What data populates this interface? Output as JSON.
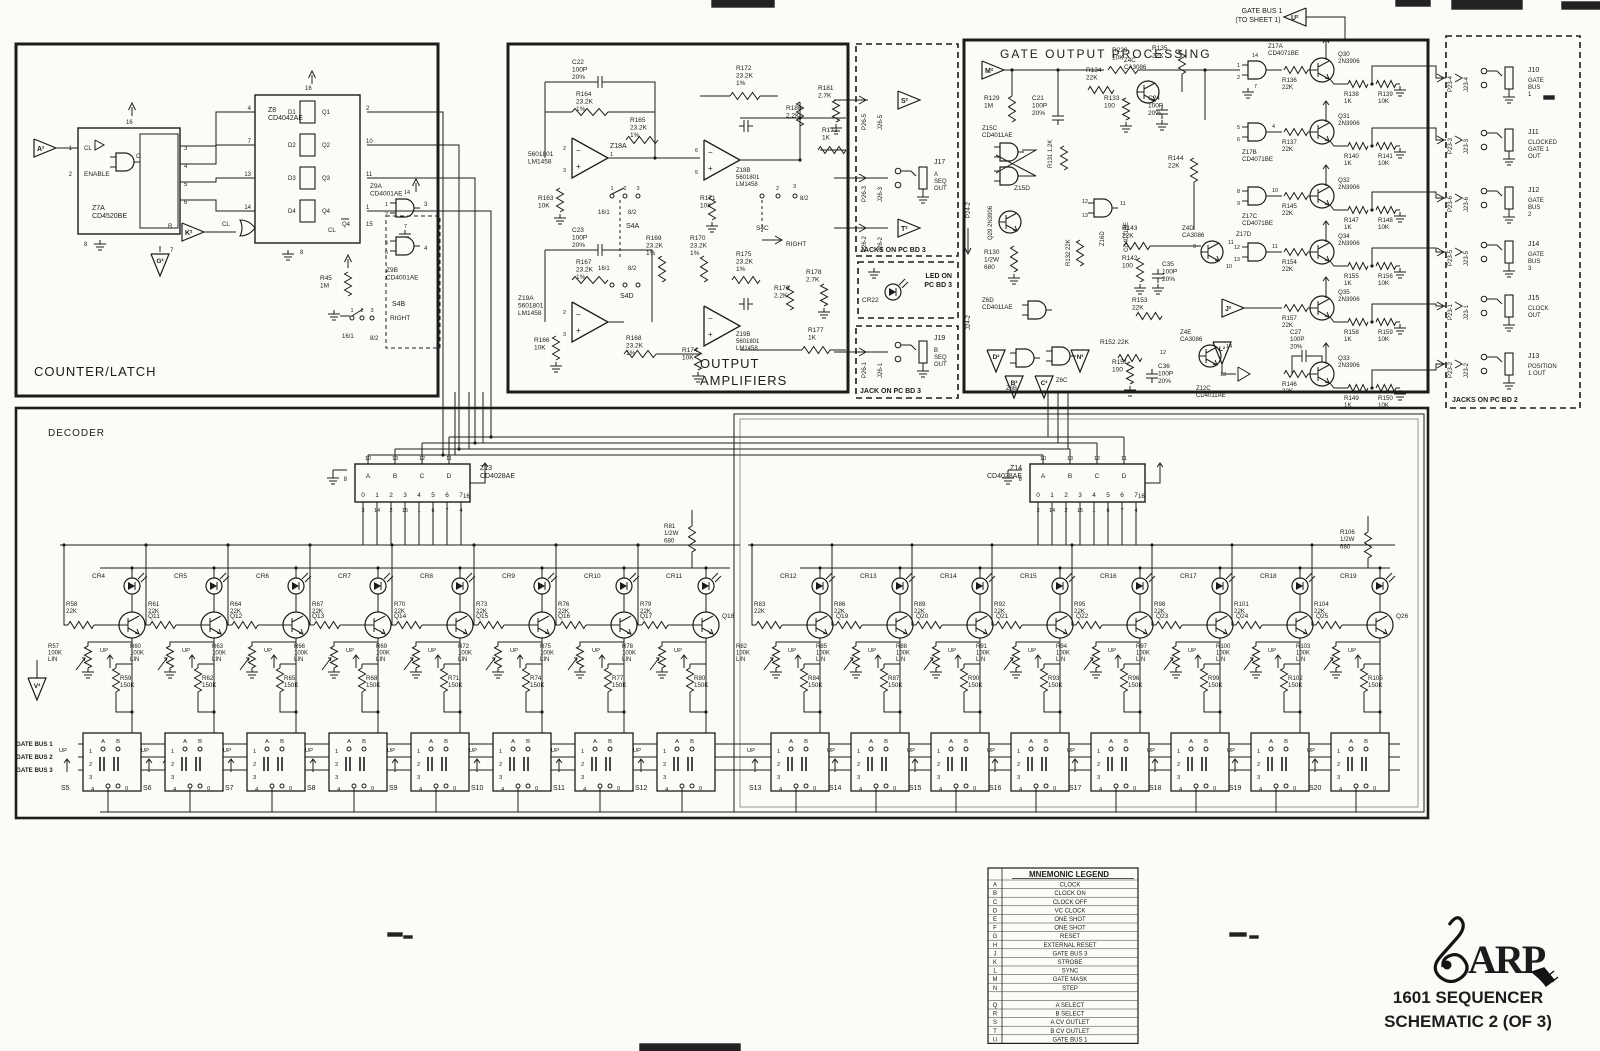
{
  "colors": {
    "ink": "#1c1c1c",
    "paper": "#fbfbf7"
  },
  "top_note": {
    "l1": "GATE BUS 1",
    "l2": "(TO SHEET 1)",
    "tri": "U²"
  },
  "counter_latch": {
    "title": "COUNTER/LATCH",
    "tri_a": "A²",
    "tri_k": "K²",
    "tri_g": "G²",
    "z7": {
      "name": "Z7A\nCD4520BE",
      "pin_cl": "1",
      "cl": "CL",
      "pin_en": "2",
      "en": "ENABLE",
      "c": "C",
      "top": "16",
      "bot": "8",
      "r": "R",
      "pin_r": "7",
      "outs": [
        "3",
        "4",
        "5",
        "6"
      ]
    },
    "z8": {
      "name": "Z8\nCD4042AE",
      "top": "16",
      "bot": "8",
      "d": [
        "D1",
        "D2",
        "D3",
        "D4"
      ],
      "din": [
        "4",
        "7",
        "13",
        "14"
      ],
      "q": [
        "Q1",
        "Q2",
        "Q3",
        "Q4"
      ],
      "qp": [
        "2",
        "10",
        "11",
        "1"
      ],
      "cl": "CL",
      "clp": "5",
      "q4b": "Q4",
      "q4bp": "15"
    },
    "z9a": {
      "name": "Z9A\nCD4001AE",
      "i1": "1",
      "i2": "2",
      "o": "3",
      "top": "14",
      "bot": "7"
    },
    "z9b": {
      "name": "Z9B\nCD4001AE",
      "i1": "5",
      "i2": "6",
      "o": "4"
    },
    "r45": "R45\n1M",
    "s4b": {
      "name": "S4B",
      "p1": "1",
      "p2": "2",
      "p3": "3",
      "l": "16/1",
      "r": "8/2",
      "right": "RIGHT"
    }
  },
  "oa": {
    "title": "OUTPUT\nAMPLIFIERS",
    "c22": "C22\n100P\n20%",
    "r164": "R164\n23.2K\n1%",
    "r165": "R165\n23.2K\n1%",
    "z18a": "Z18A",
    "z18a_sub": "5601801\nLM1458",
    "r163": "R163\n10K",
    "s4a": {
      "name": "S4A",
      "p1": "1",
      "p2": "2",
      "p3": "3",
      "l": "16/1",
      "r": "8/2"
    },
    "c23": "C23\n100P\n20%",
    "r167": "R167\n23.2K\n1%",
    "z19a": "Z19A\n5601801\nLM1458",
    "r166": "R166\n10K",
    "s4d": {
      "name": "S4D",
      "l": "16/1",
      "r": "8/2"
    },
    "r168": "R168\n23.2K\n1%",
    "r169": "R169\n23.2K\n1%",
    "r170": "R170\n23.2K\n1%",
    "r171": "R171\n10K",
    "r174": "R174\n10K",
    "r172": "R172\n23.2K\n1%",
    "r175": "R175\n23.2K\n1%",
    "z18b": "Z18B\n5601801\nLM1458",
    "z19b": "Z19B\n5601801\nLM1458",
    "r180": "R180\n2.2K",
    "r181": "R181\n2.7K",
    "r173": "R173\n1K",
    "r176": "R176\n2.2K",
    "r178": "R178\n2.7K",
    "r177": "R177\n1K",
    "s4c": {
      "name": "S4C",
      "p2": "2",
      "p3": "3",
      "r": "8/2",
      "right": "RIGHT"
    },
    "pins": {
      "inm": "2",
      "inp": "3",
      "out": "1",
      "inm2": "6",
      "inp2": "5"
    }
  },
  "jacks3": {
    "title1": "JACKS ON PC BD 3",
    "title2": "LED ON\nPC BD 3",
    "title3": "JACK ON PC BD 3",
    "cr22": "CR22",
    "rows": [
      {
        "p": "P26-5",
        "j": "J26-5",
        "tri": "S²"
      },
      {
        "p": "P26-3",
        "j": "J26-3",
        "jack": "J17",
        "nm": "A\nSEQ\nOUT"
      },
      {
        "p": "P26-2",
        "j": "J26-2",
        "tri": "T²"
      },
      {
        "p": "P26-1",
        "j": "J26-1",
        "jack": "J19",
        "nm": "B\nSEQ\nOUT"
      }
    ]
  },
  "gop": {
    "title": "GATE OUTPUT PROCESSING",
    "tri_m": "M²",
    "tri_j": "J²",
    "tri_l": "L²",
    "tri_d": "D²",
    "tri_b": "B²",
    "tri_c": "C²",
    "tri_n": "N³",
    "p24": "P24-2",
    "j24": "J24-2",
    "r229": "R229\n10K",
    "r129": "R129\n1M",
    "c21": "C21\n100P\n20%",
    "z15c": "Z15C\nCD4011AE",
    "z15d": "Z15D",
    "q29": "Q29 2N3906",
    "r130": "R130\n1/2W\n680",
    "r131": "R131 1.2K",
    "r132": "R132 22K",
    "z16d": "Z16D",
    "cd4071": "CD4071BE",
    "z6d": "Z6D\nCD4011AE",
    "z6b": "Z6B",
    "z6c": "Z6C",
    "r134": "R134\n22K",
    "r135": "R135\n22K",
    "z4c": "Z4C\nCA3086",
    "r133": "R133\n100",
    "c24": "C24\n100P\n20%",
    "r144": "R144\n22K",
    "r143": "R143\n22K",
    "z4d": "Z4D\nCA3086",
    "r142": "R142\n100",
    "c35": "C35\n100P\n20%",
    "z4d_p": [
      "9",
      "11",
      "10"
    ],
    "r153": "R153\n22K",
    "r152": "R152 22K",
    "p12": "12",
    "z4e": "Z4E\nCA3086",
    "z4e_p": [
      "14",
      "13"
    ],
    "r151": "R151\n100",
    "c36": "C36\n100P\n20%",
    "z12c": "Z12C\nCD4011AE",
    "c27": "C27\n100P\n20%",
    "rows": [
      {
        "g": "Z17A\nCD4071BE",
        "ga": "1",
        "gb": "2",
        "gt": "14",
        "gg": "7",
        "r": "R136\n22K",
        "q": "Q30\n2N3906",
        "r1": "R138\n1K",
        "r2": "R139\n10K"
      },
      {
        "g": "Z17B\nCD4071BE",
        "ga": "5",
        "gb": "6",
        "go": "4",
        "r": "R137\n22K",
        "q": "Q31\n2N3906",
        "r1": "R140\n1K",
        "r2": "R141\n10K"
      },
      {
        "g": "Z17C\nCD4071BE",
        "ga": "8",
        "gb": "9",
        "go": "10",
        "r": "R145\n22K",
        "q": "Q32\n2N3906",
        "r1": "R147\n1K",
        "r2": "R148\n10K"
      },
      {
        "g": "Z17D",
        "ga": "12",
        "gb": "13",
        "go": "11",
        "r": "R154\n22K",
        "q": "Q34\n2N3906",
        "r1": "R155\n1K",
        "r2": "R156\n10K"
      },
      {
        "r": "R157\n22K",
        "q": "Q35\n2N3906",
        "r1": "R158\n1K",
        "r2": "R159\n10K"
      },
      {
        "r": "R146\n22K",
        "q": "Q33\n2N3906",
        "r1": "R149\n1K",
        "r2": "R150\n10K"
      }
    ]
  },
  "jacks2": {
    "title": "JACKS ON PC BD 2",
    "rows": [
      {
        "p": "P23-4",
        "j": "J23-4",
        "jack": "J10",
        "nm": "GATE\nBUS\n1"
      },
      {
        "p": "P23-3",
        "j": "J23-3",
        "jack": "J11",
        "nm": "CLOCKED\nGATE 1\nOUT"
      },
      {
        "p": "P23-6",
        "j": "J23-6",
        "jack": "J12",
        "nm": "GATE\nBUS\n2"
      },
      {
        "p": "P23-5",
        "j": "J23-5",
        "jack": "J14",
        "nm": "GATE\nBUS\n3"
      },
      {
        "p": "P23-1",
        "j": "J23-1",
        "jack": "J15",
        "nm": "CLOCK\nOUT"
      },
      {
        "p": "P23-2",
        "j": "J23-2",
        "jack": "J13",
        "nm": "POSITION\n1 OUT"
      }
    ]
  },
  "decoder": {
    "title": "DECODER",
    "z13": "Z13\nCD4028AE",
    "z14": "Z14\nCD4028AE",
    "ins": [
      "A",
      "B",
      "C",
      "D"
    ],
    "inp": [
      "10",
      "13",
      "12",
      "11"
    ],
    "outs": [
      "0",
      "1",
      "2",
      "3",
      "4",
      "5",
      "6",
      "7"
    ],
    "outp": [
      "3",
      "14",
      "2",
      "15",
      "1",
      "6",
      "7",
      "4"
    ],
    "gnd": "8",
    "vdd": "16",
    "r81": "R81\n1/2W\n680",
    "r106": "R106\n1/2W\n680",
    "tri_v": "V²",
    "up": "UP",
    "bus": [
      "GATE BUS 1",
      "GATE BUS 2",
      "GATE BUS 3"
    ],
    "sw": {
      "a": "A",
      "b": "B",
      "p1": "1",
      "p2": "2",
      "p3": "3",
      "p4": "4",
      "p0": "0"
    },
    "stages_left": [
      {
        "led": "CR4",
        "r": "R58\n22K",
        "q": "Q11",
        "pot": "R57\n100K\nLIN",
        "rb": "R59\n150K"
      },
      {
        "led": "CR5",
        "r": "R61\n22K",
        "q": "Q12",
        "pot": "R60\n100K\nLIN",
        "rb": "R62\n150K"
      },
      {
        "led": "CR6",
        "r": "R64\n22K",
        "q": "Q13",
        "pot": "R63\n100K\nLIN",
        "rb": "R65\n150K"
      },
      {
        "led": "CR7",
        "r": "R67\n22K",
        "q": "Q14",
        "pot": "R66\n100K\nLIN",
        "rb": "R68\n150K"
      },
      {
        "led": "CR8",
        "r": "R70\n22K",
        "q": "Q15",
        "pot": "R69\n100K\nLIN",
        "rb": "R71\n150K"
      },
      {
        "led": "CR9",
        "r": "R73\n22K",
        "q": "Q16",
        "pot": "R72\n100K\nLIN",
        "rb": "R74\n150K"
      },
      {
        "led": "CR10",
        "r": "R76\n22K",
        "q": "Q17",
        "pot": "R75\n100K\nLIN",
        "rb": "R77\n150K"
      },
      {
        "led": "CR11",
        "r": "R79\n22K",
        "q": "Q18",
        "pot": "R78\n100K\nLIN",
        "rb": "R80\n150K"
      }
    ],
    "stages_right": [
      {
        "led": "CR12",
        "r": "R83\n22K",
        "q": "Q19",
        "pot": "R82\n100K\nLIN",
        "rb": "R84\n150K"
      },
      {
        "led": "CR13",
        "r": "R86\n22K",
        "q": "Q20",
        "pot": "R85\n100K\nLIN",
        "rb": "R87\n150K"
      },
      {
        "led": "CR14",
        "r": "R89\n22K",
        "q": "Q21",
        "pot": "R88\n100K\nLIN",
        "rb": "R90\n150K"
      },
      {
        "led": "CR15",
        "r": "R92\n22K",
        "q": "Q22",
        "pot": "R91\n100K\nLIN",
        "rb": "R93\n150K"
      },
      {
        "led": "CR16",
        "r": "R95\n22K",
        "q": "Q23",
        "pot": "R94\n100K\nLIN",
        "rb": "R96\n150K"
      },
      {
        "led": "CR17",
        "r": "R98\n22K",
        "q": "Q24",
        "pot": "R97\n100K\nLIN",
        "rb": "R99\n150K"
      },
      {
        "led": "CR18",
        "r": "R101\n22K",
        "q": "Q25",
        "pot": "R100\n100K\nLIN",
        "rb": "R102\n150K"
      },
      {
        "led": "CR19",
        "r": "R104\n22K",
        "q": "Q26",
        "pot": "R103\n100K\nLIN",
        "rb": "R105\n150K"
      }
    ],
    "sw_left": [
      "S5",
      "S6",
      "S7",
      "S8",
      "S9",
      "S10",
      "S11",
      "S12"
    ],
    "sw_right": [
      "S13",
      "S14",
      "S15",
      "S16",
      "S17",
      "S18",
      "S19",
      "S20"
    ]
  },
  "legend": {
    "title": "MNEMONIC LEGEND",
    "rows": [
      [
        "A",
        "CLOCK"
      ],
      [
        "B",
        "CLOCK ON"
      ],
      [
        "C",
        "CLOCK OFF"
      ],
      [
        "D",
        "VC CLOCK"
      ],
      [
        "E",
        "ONE SHOT"
      ],
      [
        "F",
        "ONE SHOT"
      ],
      [
        "G",
        "RESET"
      ],
      [
        "H",
        "EXTERNAL RESET"
      ],
      [
        "J",
        "GATE BUS 3"
      ],
      [
        "K",
        "STROBE"
      ],
      [
        "L",
        "SYNC"
      ],
      [
        "M",
        "GATE MASK"
      ],
      [
        "N",
        "STEP"
      ],
      [
        "",
        ""
      ],
      [
        "Q",
        "A SELECT"
      ],
      [
        "R",
        "B SELECT"
      ],
      [
        "S",
        "A CV OUTLET"
      ],
      [
        "T",
        "B CV OUTLET"
      ],
      [
        "U",
        "GATE BUS 1"
      ]
    ]
  },
  "footer": {
    "brand": "ARP",
    "line1": "1601 SEQUENCER",
    "line2": "SCHEMATIC 2 (OF 3)"
  }
}
